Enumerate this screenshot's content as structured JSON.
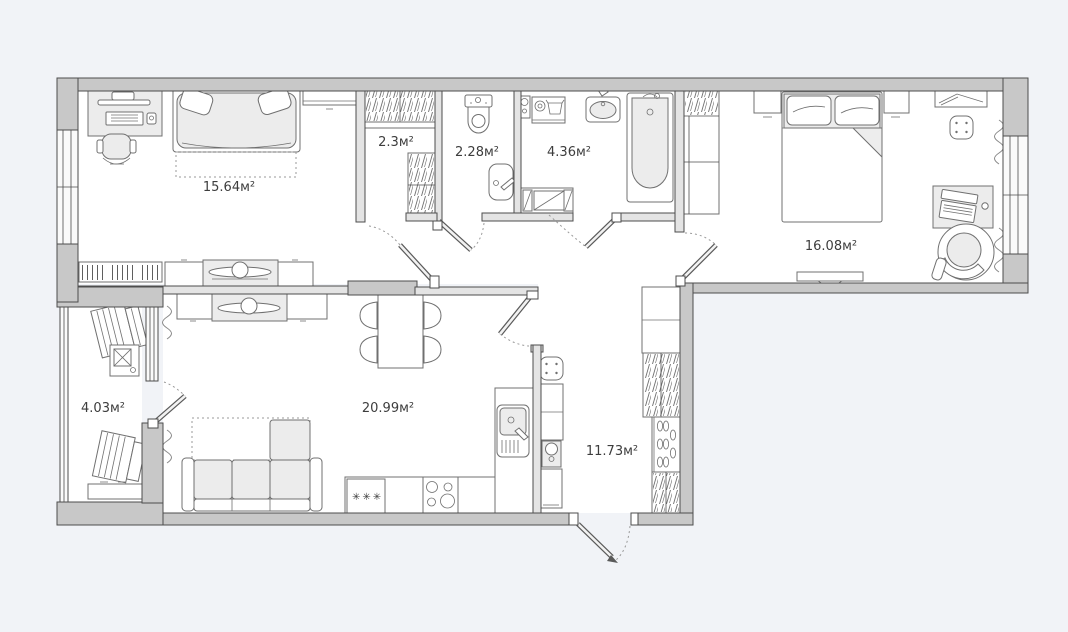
{
  "plan": {
    "type": "apartment-floor-plan",
    "unit": "м²",
    "rooms": [
      {
        "key": "living-room",
        "area_label": "15.64м²"
      },
      {
        "key": "wardrobe-closet",
        "area_label": "2.3м²"
      },
      {
        "key": "wc",
        "area_label": "2.28м²"
      },
      {
        "key": "bathroom",
        "area_label": "4.36м²"
      },
      {
        "key": "bedroom",
        "area_label": "16.08м²"
      },
      {
        "key": "balcony",
        "area_label": "4.03м²"
      },
      {
        "key": "kitchen-living-room",
        "area_label": "20.99м²"
      },
      {
        "key": "hallway",
        "area_label": "11.73м²"
      }
    ],
    "symbols": {
      "freezer_stars": "✳✳✳"
    },
    "colors": {
      "background": "#f1f3f7",
      "floor": "#ffffff",
      "exterior_wall": "#c8c8c8",
      "interior_wall": "#e4e4e4",
      "outline": "#4d4d4d",
      "furniture_fill": "#ececec"
    }
  }
}
